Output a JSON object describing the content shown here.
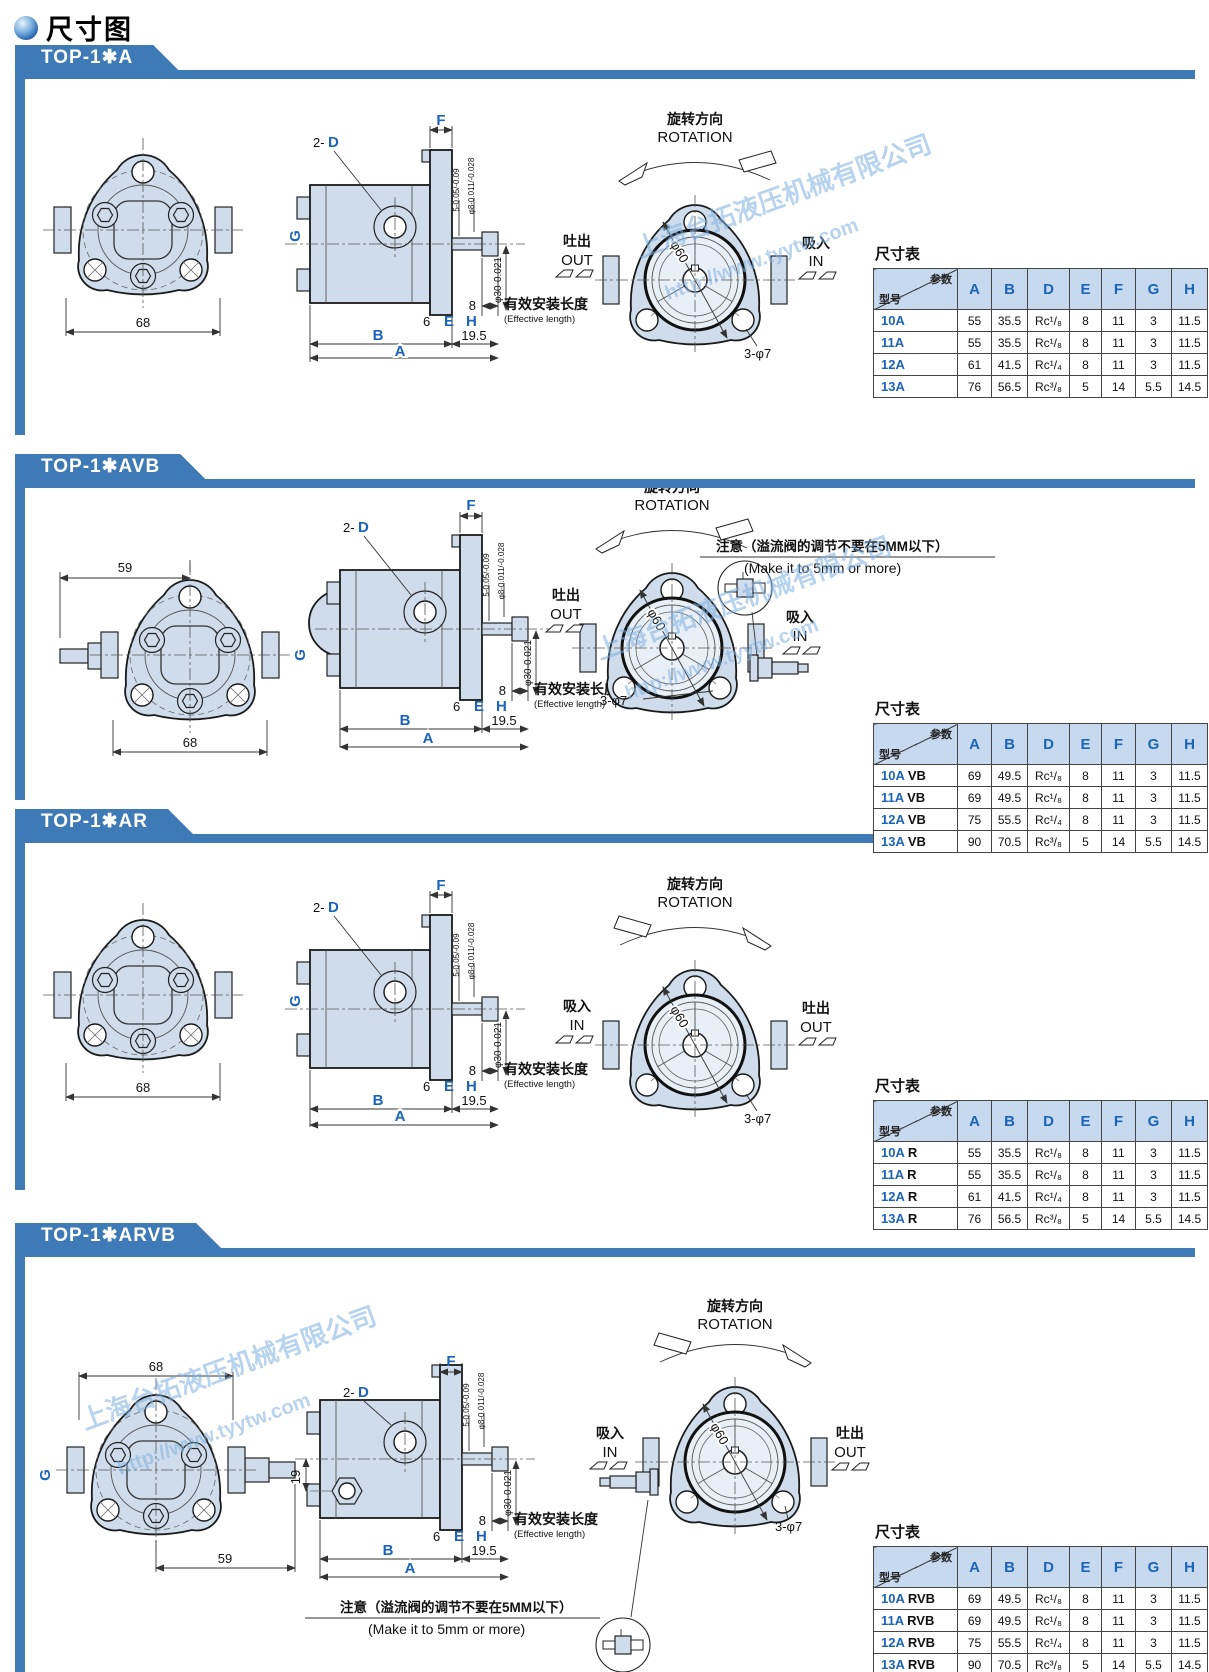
{
  "page": {
    "title": "尺寸图"
  },
  "watermark": {
    "line1": "上海台拓液压机械有限公司",
    "line2": "http://www.tyytw.com"
  },
  "labels": {
    "rot_cn": "旋转方向",
    "rot_en": "ROTATION",
    "out_cn": "吐出",
    "out_en": "OUT",
    "in_cn": "吸入",
    "in_en": "IN",
    "n8": "8",
    "eff_cn": "有效安装长度",
    "eff_en": "(Effective length)",
    "note_cn": "注意（溢流阀的调节不要在5MM以下）",
    "note_en": "(Make it to 5mm or more)",
    "tbl": "尺寸表",
    "param": "参数",
    "model": "型号",
    "p2": "2-",
    "D": "D",
    "F": "F",
    "G": "G",
    "B": "B",
    "A": "A",
    "E": "E",
    "H": "H",
    "n6": "6",
    "n195": "19.5",
    "n68": "68",
    "n59": "59",
    "n19": "19",
    "phi60": "φ60",
    "phi7": "3-φ7",
    "tol5": "5-0.05/-0.09",
    "tolp8": "φ8-0.011/-0.028",
    "tolp30": "φ30-0.021"
  },
  "sections": [
    {
      "title": "TOP-1✱A",
      "table": {
        "columns": [
          "A",
          "B",
          "D",
          "E",
          "F",
          "G",
          "H"
        ],
        "rows": [
          {
            "model": "10A",
            "suffix": "",
            "values": [
              "55",
              "35.5",
              "Rc¹/₈",
              "8",
              "11",
              "3",
              "11.5"
            ]
          },
          {
            "model": "11A",
            "suffix": "",
            "values": [
              "55",
              "35.5",
              "Rc¹/₈",
              "8",
              "11",
              "3",
              "11.5"
            ]
          },
          {
            "model": "12A",
            "suffix": "",
            "values": [
              "61",
              "41.5",
              "Rc¹/₄",
              "8",
              "11",
              "3",
              "11.5"
            ]
          },
          {
            "model": "13A",
            "suffix": "",
            "values": [
              "76",
              "56.5",
              "Rc³/₈",
              "5",
              "14",
              "5.5",
              "14.5"
            ]
          }
        ]
      }
    },
    {
      "title": "TOP-1✱AVB",
      "table": {
        "columns": [
          "A",
          "B",
          "D",
          "E",
          "F",
          "G",
          "H"
        ],
        "rows": [
          {
            "model": "10A",
            "suffix": "VB",
            "values": [
              "69",
              "49.5",
              "Rc¹/₈",
              "8",
              "11",
              "3",
              "11.5"
            ]
          },
          {
            "model": "11A",
            "suffix": "VB",
            "values": [
              "69",
              "49.5",
              "Rc¹/₈",
              "8",
              "11",
              "3",
              "11.5"
            ]
          },
          {
            "model": "12A",
            "suffix": "VB",
            "values": [
              "75",
              "55.5",
              "Rc¹/₄",
              "8",
              "11",
              "3",
              "11.5"
            ]
          },
          {
            "model": "13A",
            "suffix": "VB",
            "values": [
              "90",
              "70.5",
              "Rc³/₈",
              "5",
              "14",
              "5.5",
              "14.5"
            ]
          }
        ]
      }
    },
    {
      "title": "TOP-1✱AR",
      "table": {
        "columns": [
          "A",
          "B",
          "D",
          "E",
          "F",
          "G",
          "H"
        ],
        "rows": [
          {
            "model": "10A",
            "suffix": "R",
            "values": [
              "55",
              "35.5",
              "Rc¹/₈",
              "8",
              "11",
              "3",
              "11.5"
            ]
          },
          {
            "model": "11A",
            "suffix": "R",
            "values": [
              "55",
              "35.5",
              "Rc¹/₈",
              "8",
              "11",
              "3",
              "11.5"
            ]
          },
          {
            "model": "12A",
            "suffix": "R",
            "values": [
              "61",
              "41.5",
              "Rc¹/₄",
              "8",
              "11",
              "3",
              "11.5"
            ]
          },
          {
            "model": "13A",
            "suffix": "R",
            "values": [
              "76",
              "56.5",
              "Rc³/₈",
              "5",
              "14",
              "5.5",
              "14.5"
            ]
          }
        ]
      }
    },
    {
      "title": "TOP-1✱ARVB",
      "table": {
        "columns": [
          "A",
          "B",
          "D",
          "E",
          "F",
          "G",
          "H"
        ],
        "rows": [
          {
            "model": "10A",
            "suffix": "RVB",
            "values": [
              "69",
              "49.5",
              "Rc¹/₈",
              "8",
              "11",
              "3",
              "11.5"
            ]
          },
          {
            "model": "11A",
            "suffix": "RVB",
            "values": [
              "69",
              "49.5",
              "Rc¹/₈",
              "8",
              "11",
              "3",
              "11.5"
            ]
          },
          {
            "model": "12A",
            "suffix": "RVB",
            "values": [
              "75",
              "55.5",
              "Rc¹/₄",
              "8",
              "11",
              "3",
              "11.5"
            ]
          },
          {
            "model": "13A",
            "suffix": "RVB",
            "values": [
              "90",
              "70.5",
              "Rc³/₈",
              "5",
              "14",
              "5.5",
              "14.5"
            ]
          }
        ]
      }
    }
  ]
}
